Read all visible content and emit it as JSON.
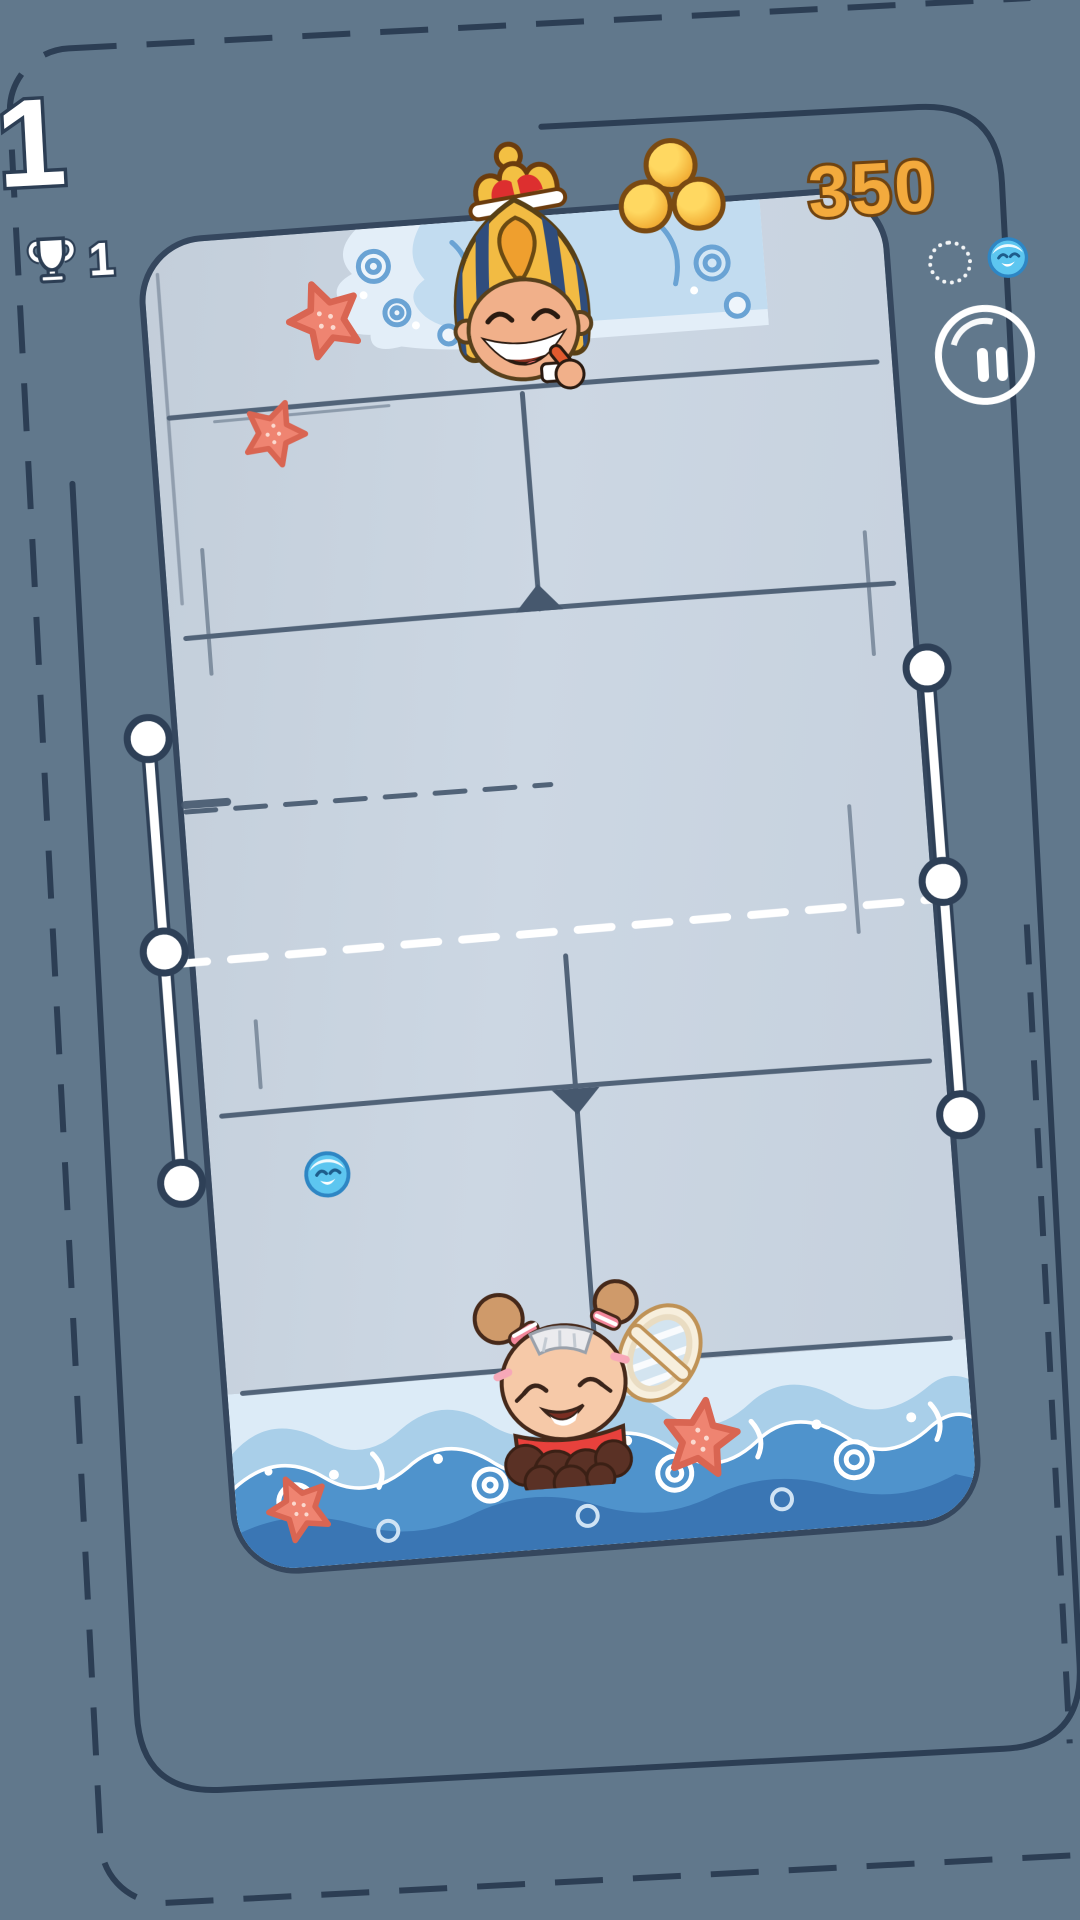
{
  "hud": {
    "level": "1",
    "best": {
      "icon": "trophy-icon",
      "value": "1"
    },
    "coins": {
      "icon": "coins-icon",
      "value": "350"
    },
    "rally_indicator": {
      "slot_empty": "dashed-circle",
      "slot_filled": "ball-icon"
    },
    "pause_icon": "pause-icon"
  },
  "players": {
    "top": "pharaoh-opponent",
    "bottom": "girl-player-with-racket"
  },
  "objects": {
    "ball": "blue-smiley-ball",
    "decorations": [
      "starfish",
      "wave-splash-top",
      "wave-band-bottom",
      "dashed-screen-border",
      "board-frame"
    ]
  },
  "colors": {
    "background": "#61788c",
    "outline": "#2c3e54",
    "court": "#c8d3e0",
    "court_line": "#46586e",
    "net": "#ffffff",
    "coin_gold": "#f2ae35",
    "coin_text": "#f3aa3d",
    "coin_outline": "#6f4310",
    "ball_blue": "#5dc6f0",
    "starfish": "#ef8471",
    "wave_blue": "#4f93cc",
    "pharaoh_gold": "#f2bb43",
    "pharaoh_stripe": "#2f4d7d",
    "girl_shirt": "#e8413c",
    "girl_hair": "#5a3125"
  }
}
